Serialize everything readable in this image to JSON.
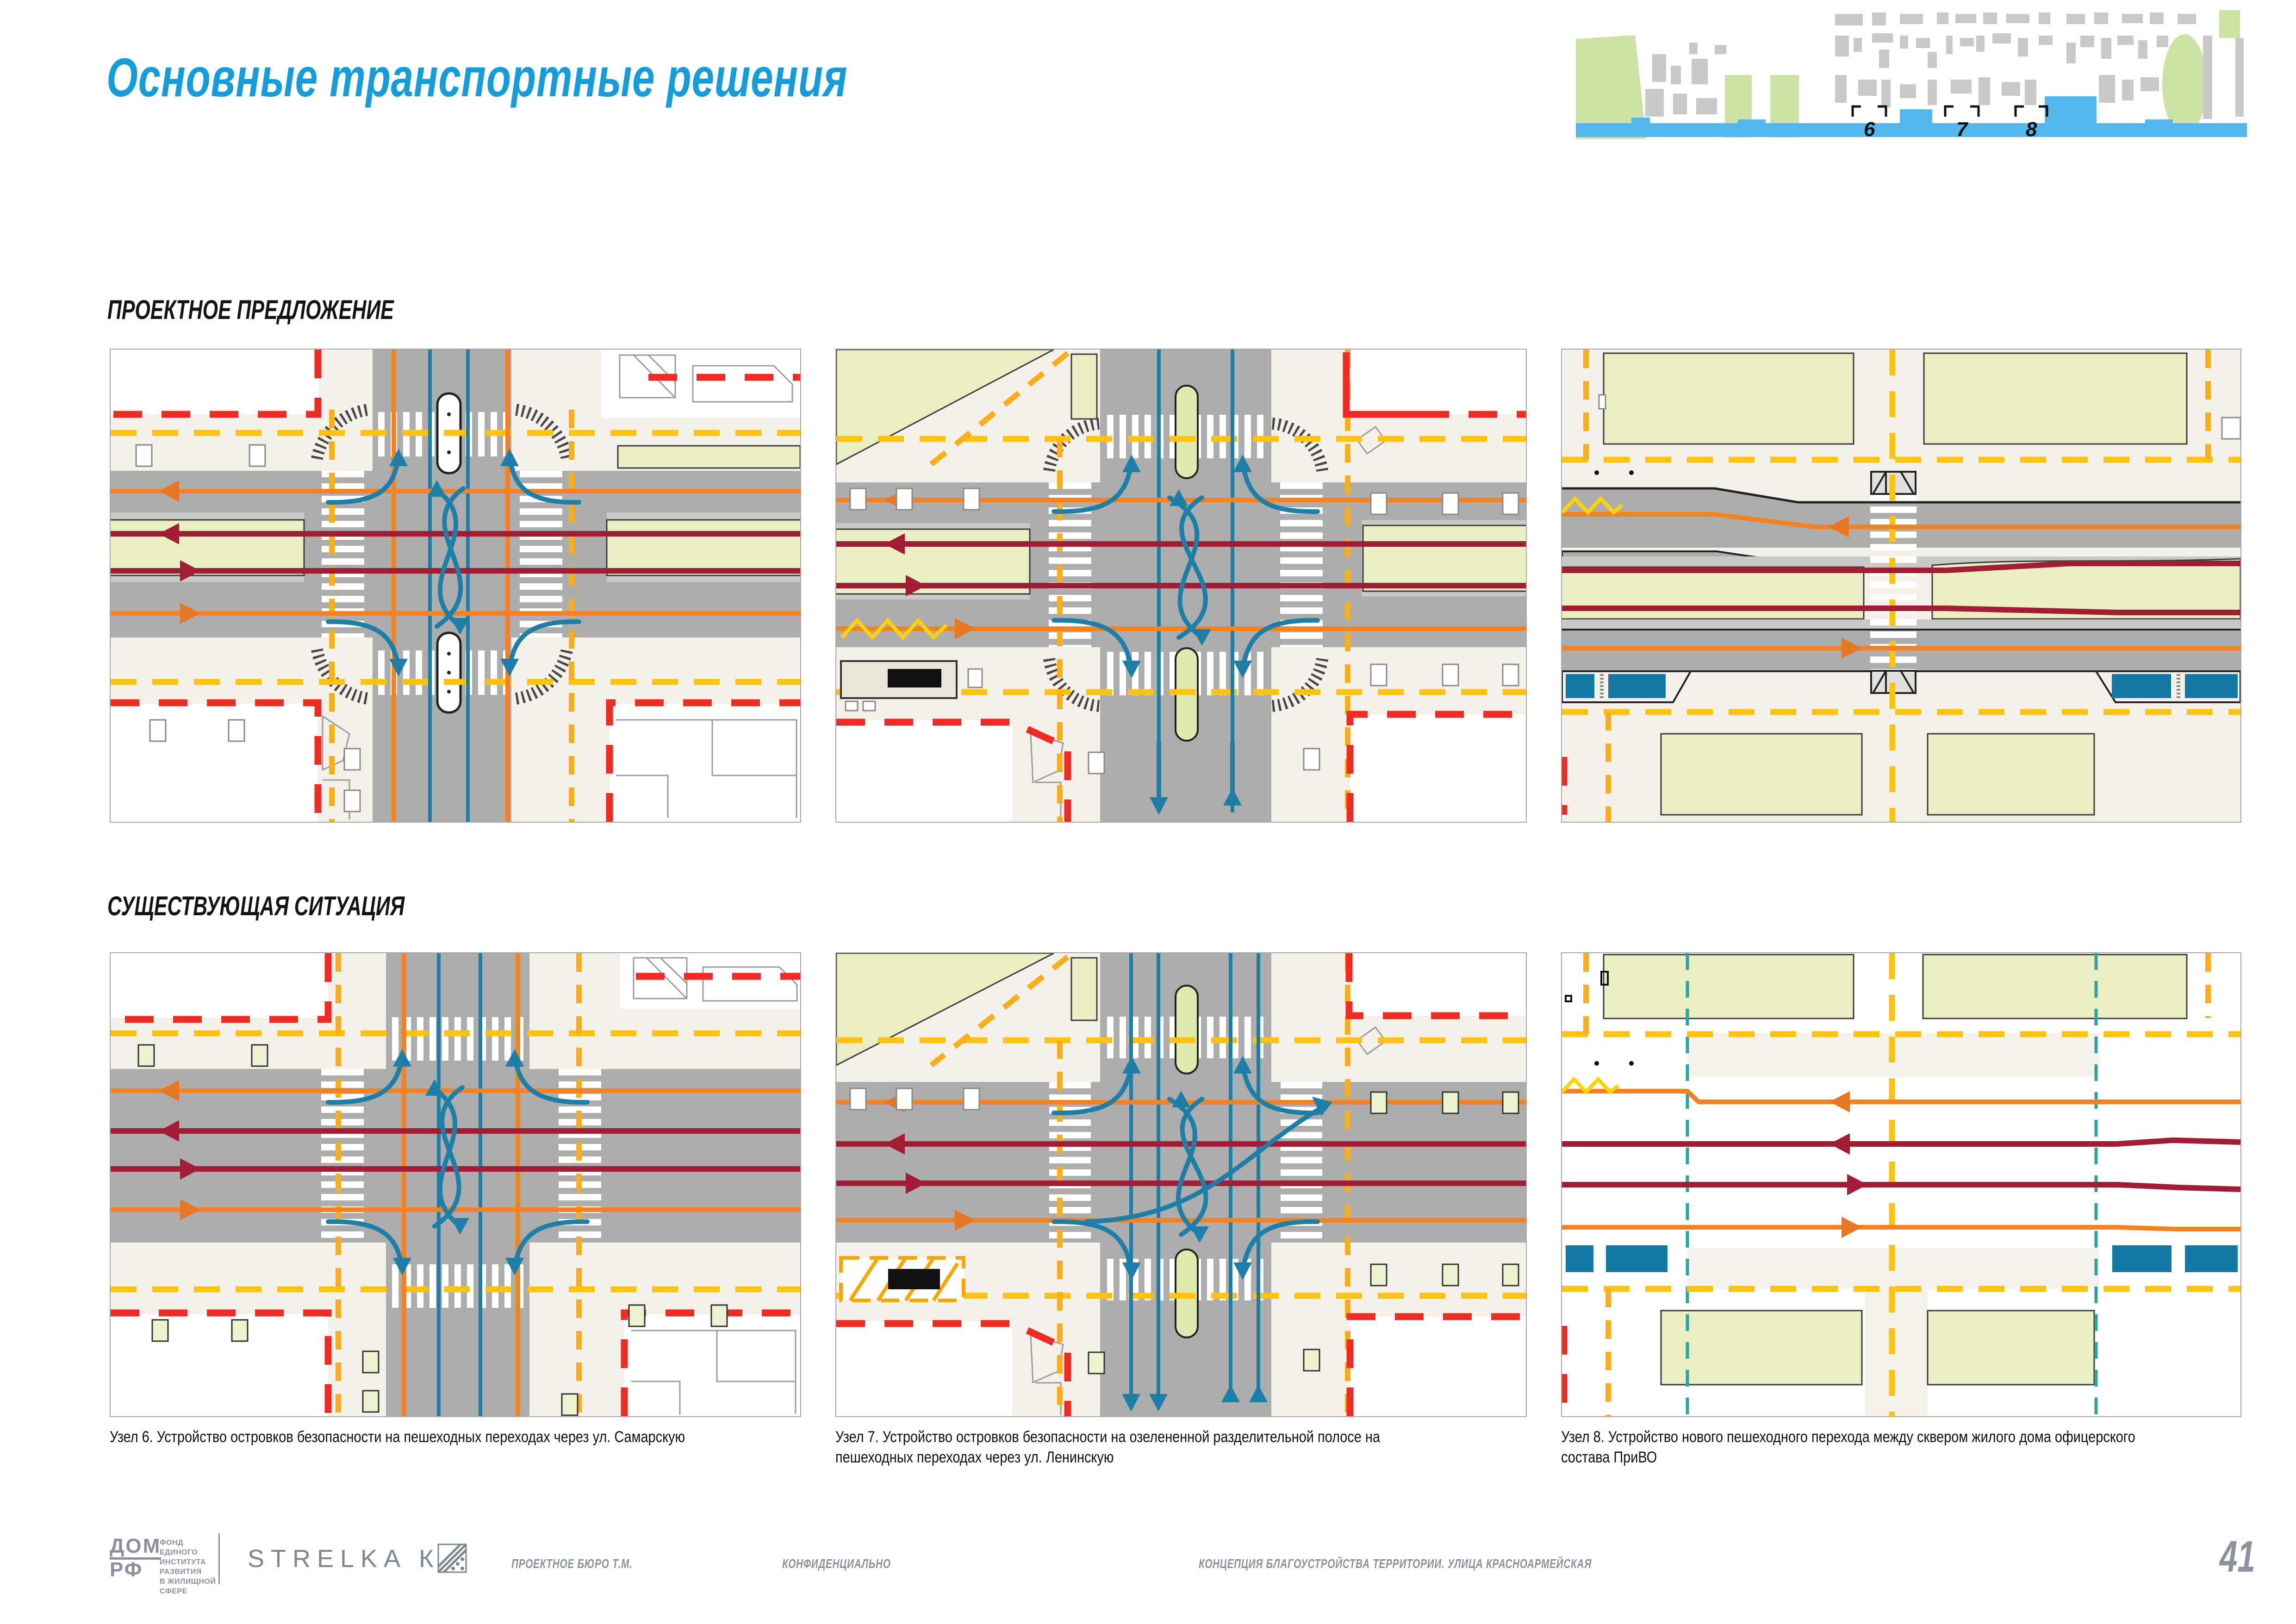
{
  "page": {
    "title": "Основные транспортные решения",
    "page_number": "41",
    "accent_blue": "#149CDB"
  },
  "sections": [
    {
      "label": "ПРОЕКТНОЕ ПРЕДЛОЖЕНИЕ"
    },
    {
      "label": "СУЩЕСТВУЮЩАЯ СИТУАЦИЯ"
    }
  ],
  "overview_map": {
    "street_color": "#52B7EA",
    "markers": [
      {
        "label": "6"
      },
      {
        "label": "7"
      },
      {
        "label": "8"
      }
    ]
  },
  "panels": [
    {
      "id": "node6-proposed",
      "row": "proposed",
      "node": "6"
    },
    {
      "id": "node7-proposed",
      "row": "proposed",
      "node": "7"
    },
    {
      "id": "node8-proposed",
      "row": "proposed",
      "node": "8"
    },
    {
      "id": "node6-existing",
      "row": "existing",
      "node": "6"
    },
    {
      "id": "node7-existing",
      "row": "existing",
      "node": "7"
    },
    {
      "id": "node8-existing",
      "row": "existing",
      "node": "8"
    }
  ],
  "captions": [
    {
      "text": "Узел 6. Устройство островков безопасности на пешеходных переходах через ул. Самарскую"
    },
    {
      "text": "Узел 7. Устройство островков безопасности на озелененной разделительной полосе на пешеходных переходах через ул. Ленинскую"
    },
    {
      "text": "Узел 8. Устройство нового пешеходного перехода между сквером жилого дома офицерского состава ПриВО"
    }
  ],
  "footer": {
    "domrf": {
      "line1": "ДОМ",
      "line2": "РФ",
      "sub_lines": [
        "ФОНД",
        "ЕДИНОГО",
        "ИНСТИТУТА",
        "РАЗВИТИЯ",
        "В ЖИЛИЩНОЙ",
        "СФЕРЕ"
      ]
    },
    "strelka": "STRELKA КБ",
    "bureau": "ПРОЕКТНОЕ БЮРО Т.М.",
    "confidential": "КОНФИДЕНЦИАЛЬНО",
    "project": "КОНЦЕПЦИЯ БЛАГОУСТРОЙСТВА ТЕРРИТОРИИ. УЛИЦА КРАСНОАРМЕЙСКАЯ"
  },
  "legend_colors": {
    "road_gray": "#ADADAD",
    "block_beige": "#F3F1EA",
    "greenery": "#E9EFC2",
    "pedestrian_yellow_dash": "#FFC20E",
    "car_traffic_orange": "#F58220",
    "transit_darkred": "#A21C33",
    "transit_teal": "#1C7FA8",
    "boundary_red_dash": "#EF2B24",
    "bus_stop_blue": "#1478A5"
  }
}
